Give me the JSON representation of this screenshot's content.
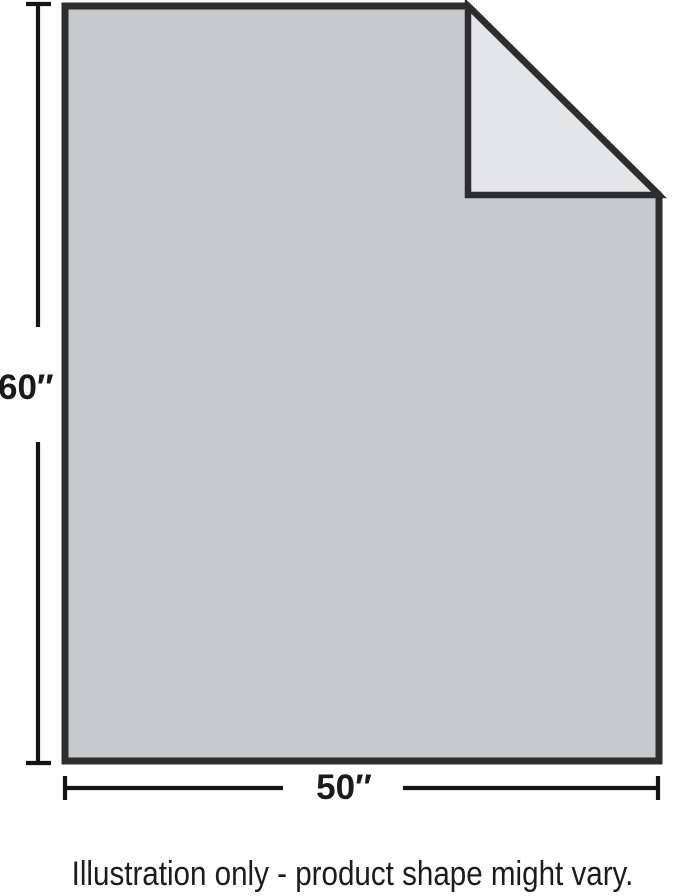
{
  "illustration": {
    "height_label": "60″",
    "width_label": "50″",
    "caption": "Illustration only - product shape might vary.",
    "colors": {
      "sheet_fill": "#c7cacb",
      "fold_fill": "#e4e5e6",
      "outline": "#2b2d2f",
      "dimension": "#141414",
      "label_text": "#1a1a1a",
      "caption_text": "#1c1c1c",
      "background": "#ffffff"
    }
  }
}
